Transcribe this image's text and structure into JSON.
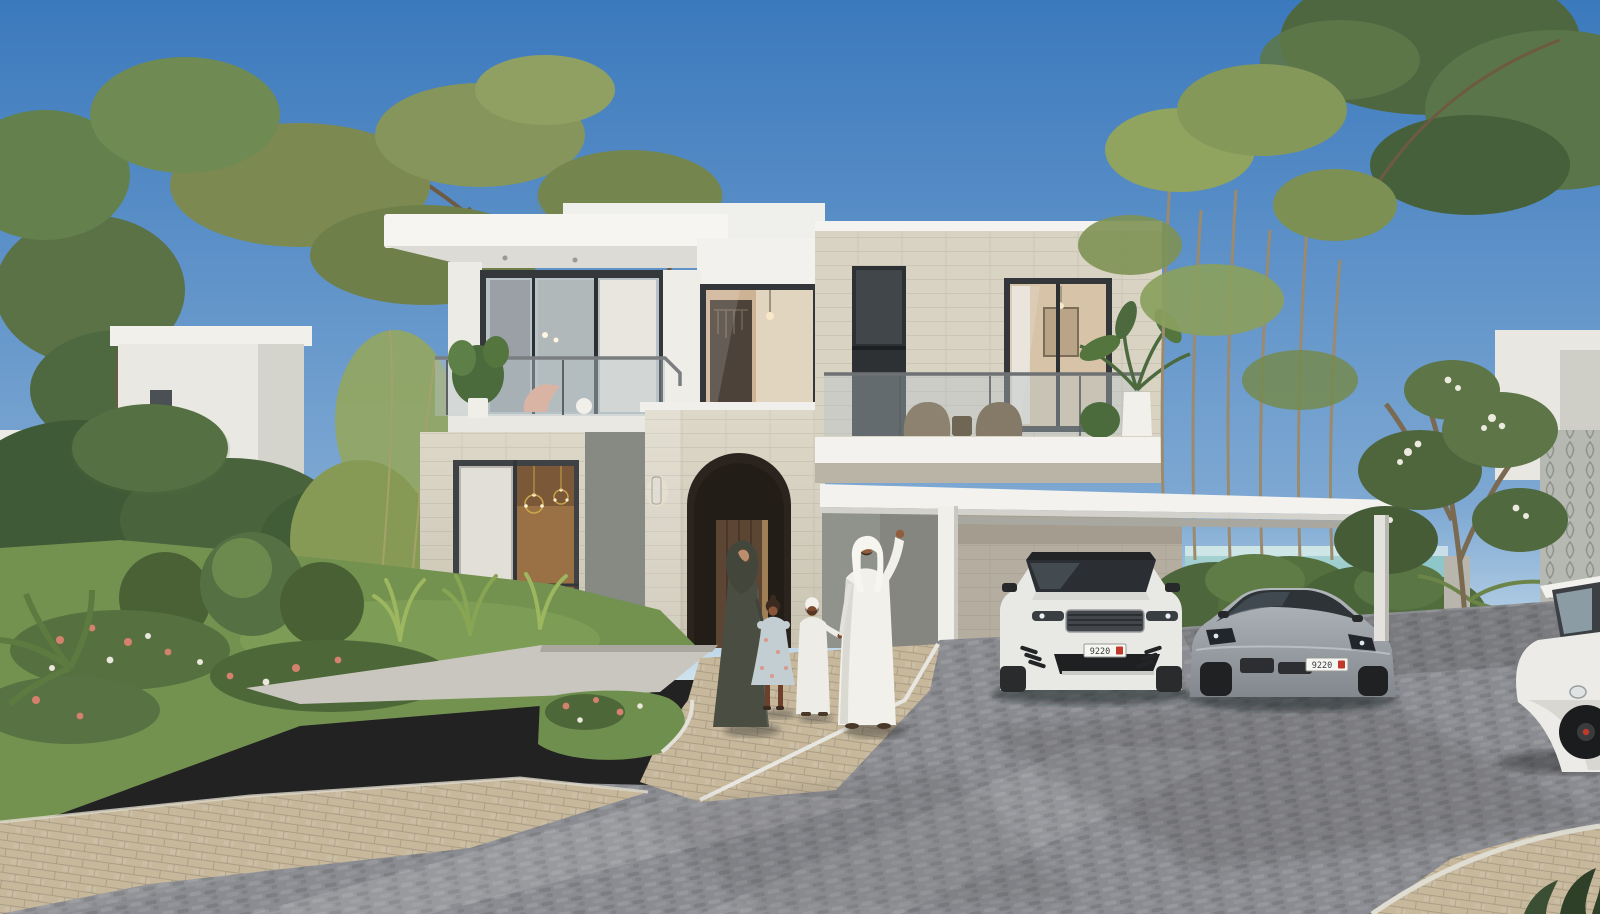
{
  "scene": {
    "description": "Photorealistic rendering of a modern two-storey villa with white flat roofs and beige stone cladding, arched entrance portal, glass-balustrade balconies, covered carport with two cars, landscaped garden, cobbled driveway and a sea glimpse on a clear sunny day",
    "time_of_day": "sunny daytime, clear blue sky",
    "location_hint": "coastal residential community",
    "people": [
      {
        "role": "mother",
        "outfit": "dark olive abaya with shayla headscarf"
      },
      {
        "role": "daughter",
        "outfit": "pale blue floral dress"
      },
      {
        "role": "son",
        "outfit": "white kandura with white prayer cap"
      },
      {
        "role": "father",
        "outfit": "white kandura and ghutra, arm raised waving"
      }
    ],
    "vehicles": [
      {
        "type": "luxury SUV",
        "color": "white",
        "plate": "9220"
      },
      {
        "type": "sports sedan",
        "color": "grey",
        "plate": "9220"
      },
      {
        "type": "golf buggy",
        "color": "white",
        "plate": ""
      }
    ],
    "villa": {
      "storeys": 2,
      "features": [
        "white flat roof slabs",
        "beige stone cladding",
        "arched entry portal with wooden door",
        "wall sconce",
        "glass balustrade balconies",
        "floor-to-ceiling glazing",
        "covered carport",
        "balcony lounge furniture",
        "palm planter"
      ]
    },
    "landscape": [
      "acacia trees",
      "bamboo clumps",
      "frangipani tree with white blossoms",
      "clipped hedge",
      "flowering shrubs pink and white",
      "agave plants",
      "lawn",
      "sea on horizon",
      "palm fronds",
      "decorative lattice screen"
    ],
    "hardscape": [
      "grey cobblestone driveway",
      "beige paver walkway",
      "smooth concrete entry path",
      "white kerbs"
    ]
  },
  "palette": {
    "sky_top": "#3b79bd",
    "sky_horizon": "#cfe2ee",
    "sea": "#8ec6c9",
    "white_trim": "#f3f2ee",
    "stone_lit": "#d8d3c3",
    "stone_shade": "#b5aea0",
    "grey_wall": "#90928c",
    "glass": "#b7c3c7",
    "frame_dark": "#33373a",
    "driveway": "#8b8c91",
    "paver": "#c7b89c",
    "concrete": "#c9c6bf",
    "foliage": "#7e8d55",
    "foliage_dark": "#4d663c",
    "grass": "#74924f",
    "flower_pink": "#d4826e",
    "accent_red": "#c0392b",
    "suv_white": "#e8e8e5",
    "sedan_grey": "#9aa0a6"
  }
}
